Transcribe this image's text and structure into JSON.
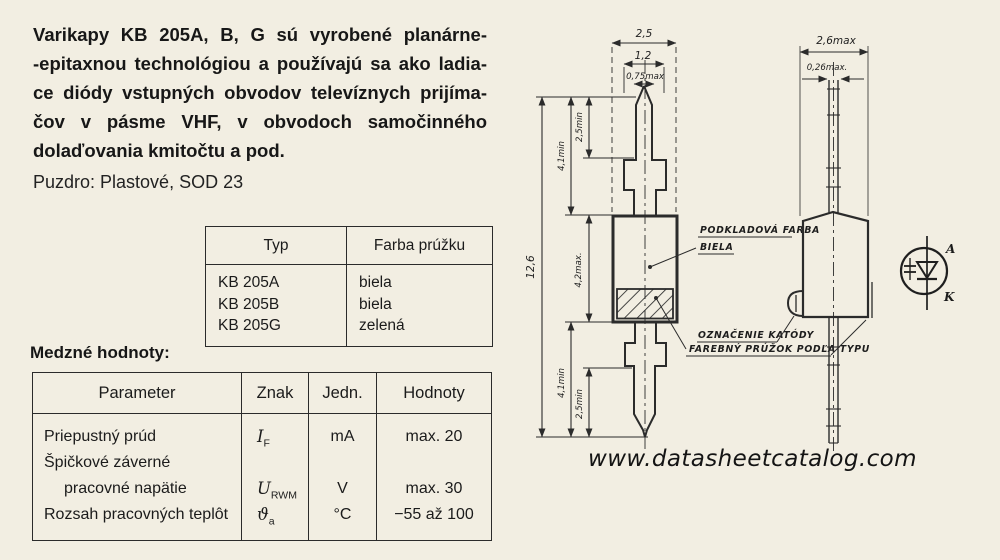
{
  "colors": {
    "paper": "#f2eee2",
    "ink": "#1d1d1d"
  },
  "intro": {
    "lines": [
      "Varikapy KB 205A, B, G sú vyrobené planárne-",
      "-epitaxnou technológiou a používajú sa ako ladia-",
      "ce diódy vstupných obvodov televíznych prijíma-",
      "čov v pásme VHF, v obvodoch samočinného",
      "dolaďovania kmitočtu a pod."
    ]
  },
  "package_line": "Puzdro: Plastové, SOD 23",
  "type_table": {
    "headers": [
      "Typ",
      "Farba prúžku"
    ],
    "rows": [
      {
        "typ": "KB 205A",
        "farba": "biela"
      },
      {
        "typ": "KB 205B",
        "farba": "biela"
      },
      {
        "typ": "KB 205G",
        "farba": "zelená"
      }
    ]
  },
  "limits": {
    "heading": "Medzné hodnoty:",
    "headers": [
      "Parameter",
      "Znak",
      "Jedn.",
      "Hodnoty"
    ],
    "rows": [
      {
        "parameter": "Priepustný prúd",
        "znak_sym": "I",
        "znak_sub": "F",
        "jedn": "mA",
        "hodnoty": "max. 20"
      },
      {
        "parameter": "Špičkové záverné",
        "znak_sym": "",
        "znak_sub": "",
        "jedn": "",
        "hodnoty": ""
      },
      {
        "parameter": "pracovné napätie",
        "znak_sym": "U",
        "znak_sub": "RWM",
        "jedn": "V",
        "hodnoty": "max. 30"
      },
      {
        "parameter": "Rozsah pracovných teplôt",
        "znak_sym": "ϑ",
        "znak_sub": "a",
        "jedn": "°C",
        "hodnoty": "−55 až 100"
      }
    ]
  },
  "drawing": {
    "dims": {
      "top_outer": "2,5",
      "top_mid": "1,2",
      "top_inner": "0,75max",
      "overall": "12,6",
      "lead_top": "4,1min",
      "lead_tip_top": "2,5min",
      "body_height": "4,2max.",
      "lead_bottom": "4,1min",
      "lead_tip_bottom": "2,5min",
      "right_width": "2,6max",
      "right_lead": "0,26max."
    },
    "labels": {
      "base_color_line1": "PODKLADOVÁ FARBA",
      "base_color_line2": "BIELA",
      "cathode_mark": "OZNAČENIE KATÓDY",
      "stripe": "FAREBNÝ PRÚŽOK PODĽA TYPU",
      "anode": "A",
      "cathode": "K"
    }
  },
  "watermark": "www.datasheetcatalog.com"
}
